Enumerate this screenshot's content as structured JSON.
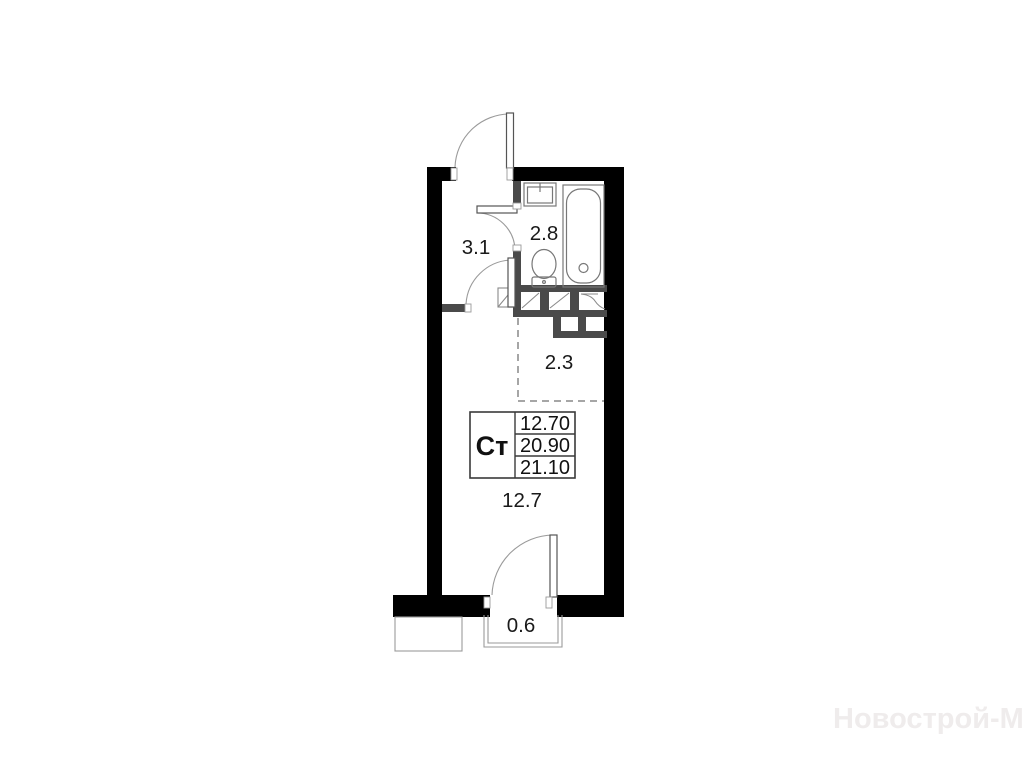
{
  "plan": {
    "unit_label": "Ст",
    "areas": {
      "hallway": "3.1",
      "bathroom": "2.8",
      "niche": "2.3",
      "room": "12.7",
      "balcony": "0.6"
    },
    "info_table": {
      "type": "Ст",
      "values": [
        "12.70",
        "20.90",
        "21.10"
      ]
    },
    "colors": {
      "exterior_wall": "#000000",
      "partition": "#4a4a4a",
      "thin_line": "#8a8a8a",
      "text": "#1a1a1a",
      "watermark": "#efecec"
    }
  },
  "watermark": {
    "text": "Новострой-М"
  }
}
